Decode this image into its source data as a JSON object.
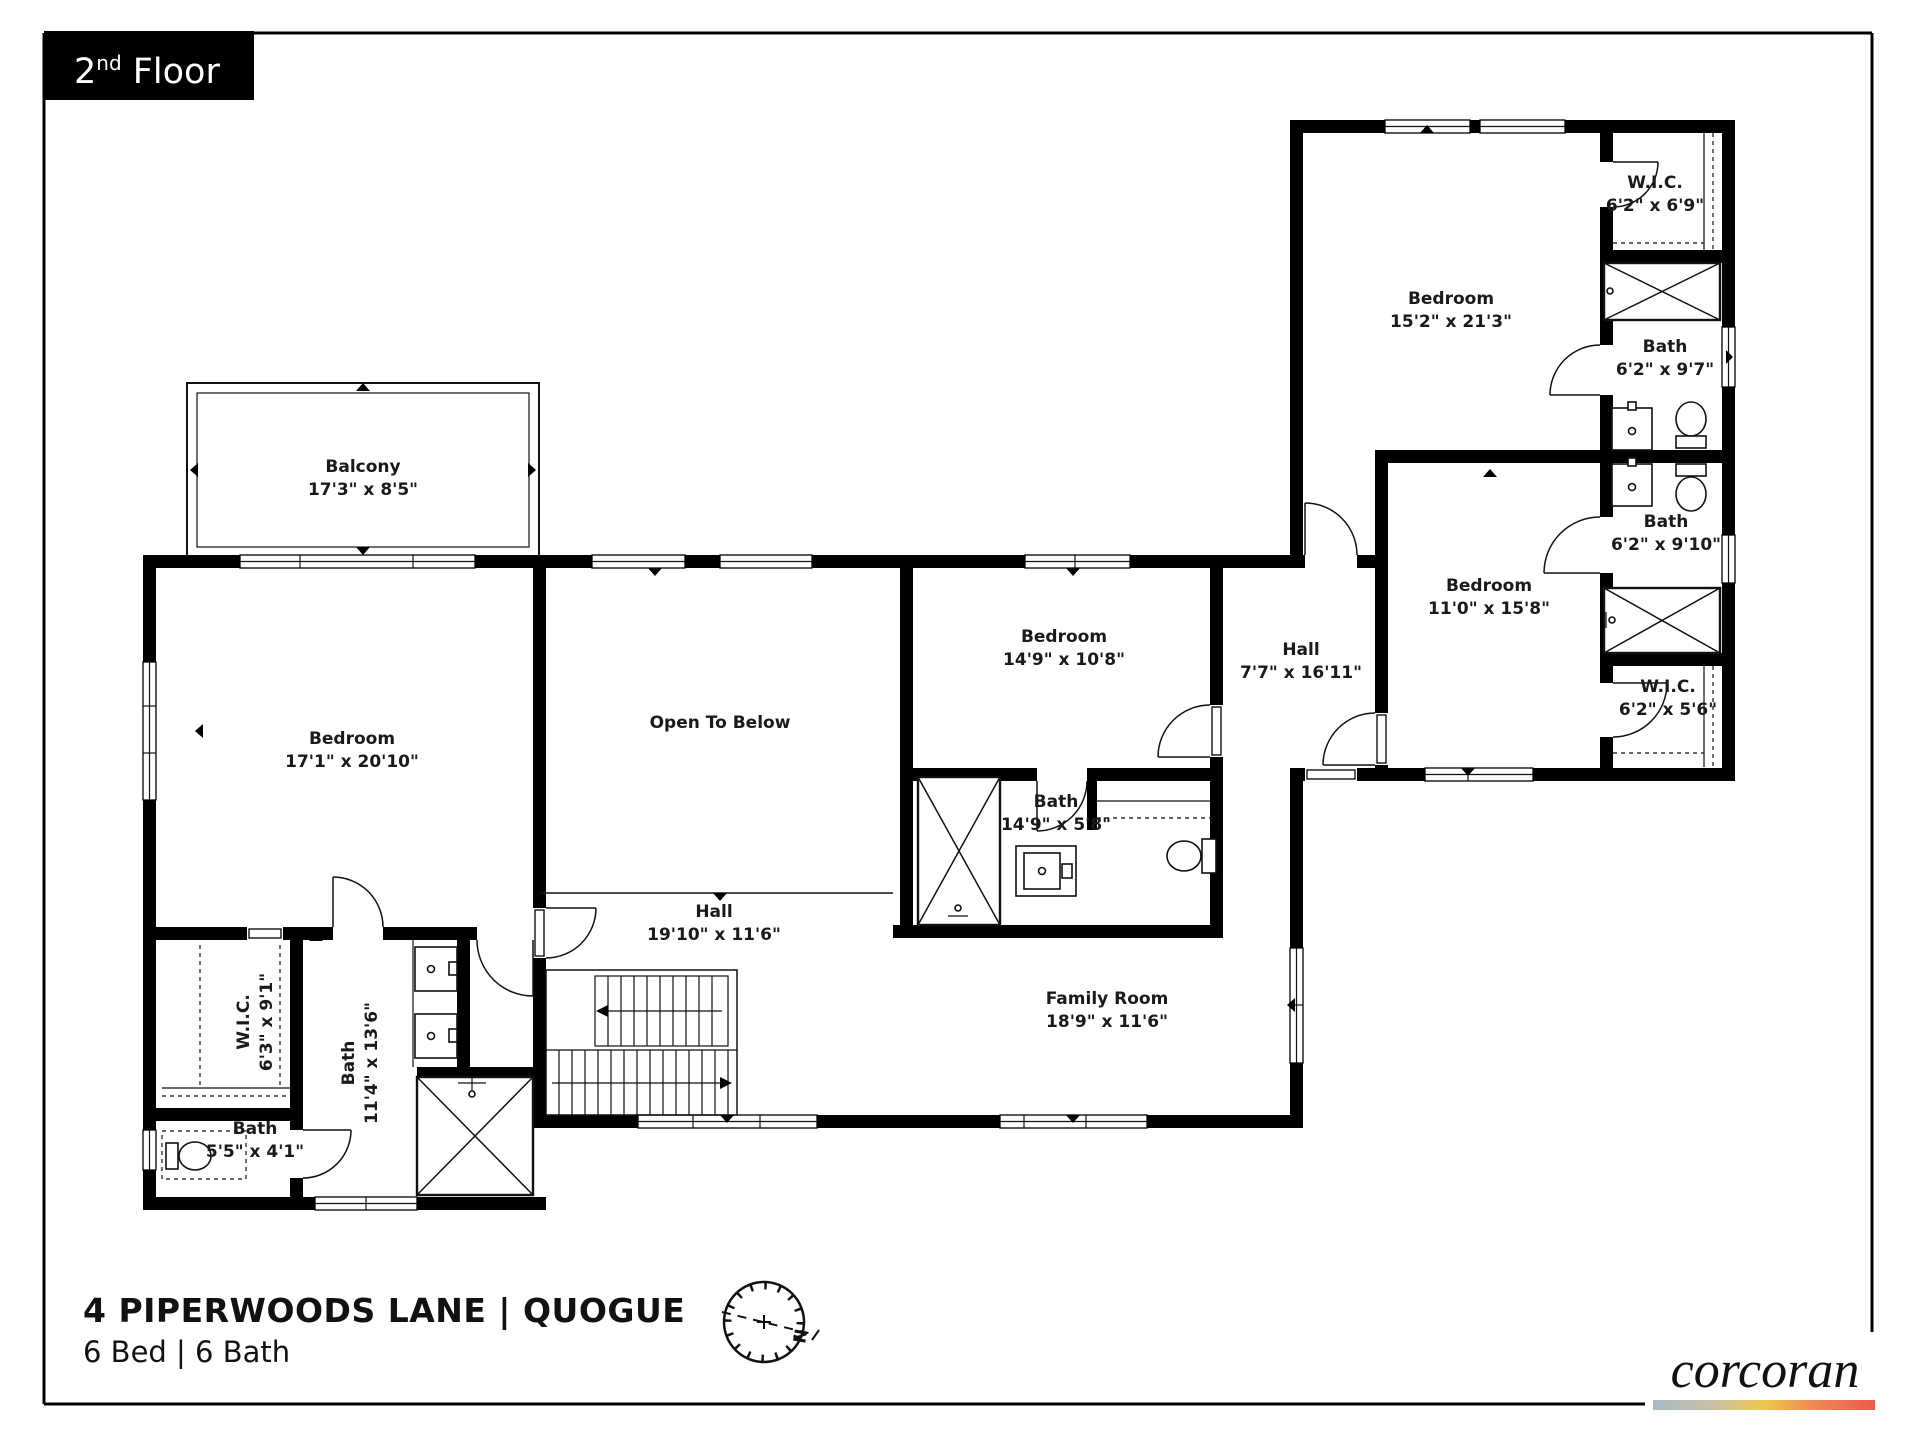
{
  "floor_label": {
    "number": "2",
    "ordinal": "nd",
    "rest": " Floor"
  },
  "address": {
    "line1": "4 PIPERWOODS LANE | QUOGUE",
    "line2": "6 Bed | 6 Bath"
  },
  "brand": {
    "name": "corcoran",
    "gradient_colors": [
      "#a5bac6",
      "#eec84e",
      "#ec5b4f"
    ]
  },
  "compass": {
    "label": "N"
  },
  "rooms": [
    {
      "name": "Balcony",
      "dims": "17'3\" x 8'5\""
    },
    {
      "name": "Bedroom",
      "dims": "17'1\" x 20'10\""
    },
    {
      "name": "Open To Below",
      "dims": ""
    },
    {
      "name": "Bedroom",
      "dims": "14'9\" x 10'8\""
    },
    {
      "name": "Bath",
      "dims": "14'9\" x 5'8\""
    },
    {
      "name": "Hall",
      "dims": "7'7\" x 16'11\""
    },
    {
      "name": "Bedroom",
      "dims": "15'2\" x 21'3\""
    },
    {
      "name": "W.I.C.",
      "dims": "6'2\" x 6'9\""
    },
    {
      "name": "Bath",
      "dims": "6'2\" x 9'7\""
    },
    {
      "name": "Bath",
      "dims": "6'2\" x 9'10\""
    },
    {
      "name": "W.I.C.",
      "dims": "6'2\" x 5'6\""
    },
    {
      "name": "Bedroom",
      "dims": "11'0\" x 15'8\""
    },
    {
      "name": "Hall",
      "dims": "19'10\" x 11'6\""
    },
    {
      "name": "Family Room",
      "dims": "18'9\" x 11'6\""
    },
    {
      "name": "W.I.C.",
      "dims": "6'3\" x 9'1\""
    },
    {
      "name": "Bath",
      "dims": "11'4\" x 13'6\""
    },
    {
      "name": "Bath",
      "dims": "5'5\" x 4'1\""
    }
  ]
}
